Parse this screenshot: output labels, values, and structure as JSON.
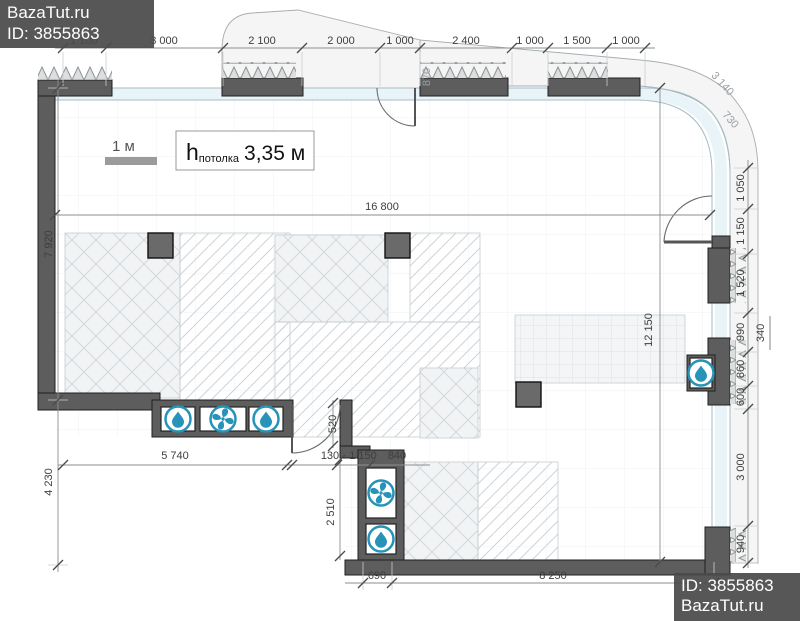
{
  "watermarks": {
    "top": {
      "line1": "BazaTut.ru",
      "line2": "ID: 3855863"
    },
    "bottom": {
      "line1": "ID: 3855863",
      "line2": "BazaTut.ru"
    }
  },
  "scale_bar": {
    "label": "1 м"
  },
  "ceiling": {
    "h": "h",
    "sub": "потолка",
    "value": "3,35 м"
  },
  "dims": {
    "top": [
      "1 100",
      "3 000",
      "2 100",
      "2 000",
      "1 000",
      "2 400",
      "1 000",
      "1 500",
      "1 000"
    ],
    "left": [
      "7 920",
      "4 230"
    ],
    "right": [
      "1 050",
      "1 150",
      "1 520",
      "990",
      "340",
      "860",
      "600",
      "3 000",
      "940"
    ],
    "inner": [
      "5 740",
      "130",
      "1 150",
      "840"
    ],
    "bottom": [
      "690",
      "8 250"
    ],
    "overall": {
      "width": "16 800",
      "height": "12 150"
    },
    "misc": {
      "door_top": "870",
      "door_bottom": "520",
      "shaft": "2 510",
      "curve_outer": "3 140",
      "curve_inner": "730"
    }
  },
  "icons": {
    "water": "water-drop-icon",
    "fan": "fan-icon"
  },
  "colors": {
    "wall": "#5d5d5d",
    "glazing": "#e9f4f9",
    "icon_blue": "#2793b8",
    "watermark_bg": "#4a4a4a",
    "dim_text": "#3e3e3e"
  }
}
